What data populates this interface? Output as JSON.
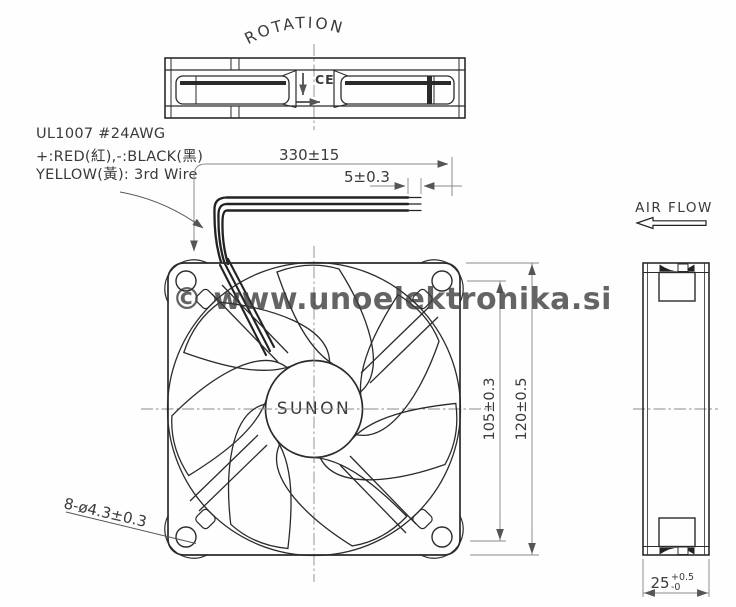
{
  "colors": {
    "line": "#2b2b2b",
    "dim_line": "#8a8a8a",
    "watermark": "#8f8f8f",
    "background": "#fefefe"
  },
  "drawing": {
    "rotation_label": "ROTATION",
    "ce_mark": "CE",
    "brand": "SUNON",
    "air_flow_label": "AIR FLOW",
    "watermark": "© www.unoelektronika.si",
    "wire_spec": {
      "line1": "UL1007 #24AWG",
      "line2": "+:RED(紅),-:BLACK(黑)",
      "line3": "YELLOW(黃): 3rd Wire"
    },
    "dimensions": {
      "wire_length": "330±15",
      "strip_length": "5±0.3",
      "hole_pitch": "105±0.3",
      "frame_size": "120±0.5",
      "mounting_holes": "8-ø4.3±0.3",
      "depth_value": "25",
      "depth_tol_plus": "+0.5",
      "depth_tol_minus": "-0"
    }
  }
}
